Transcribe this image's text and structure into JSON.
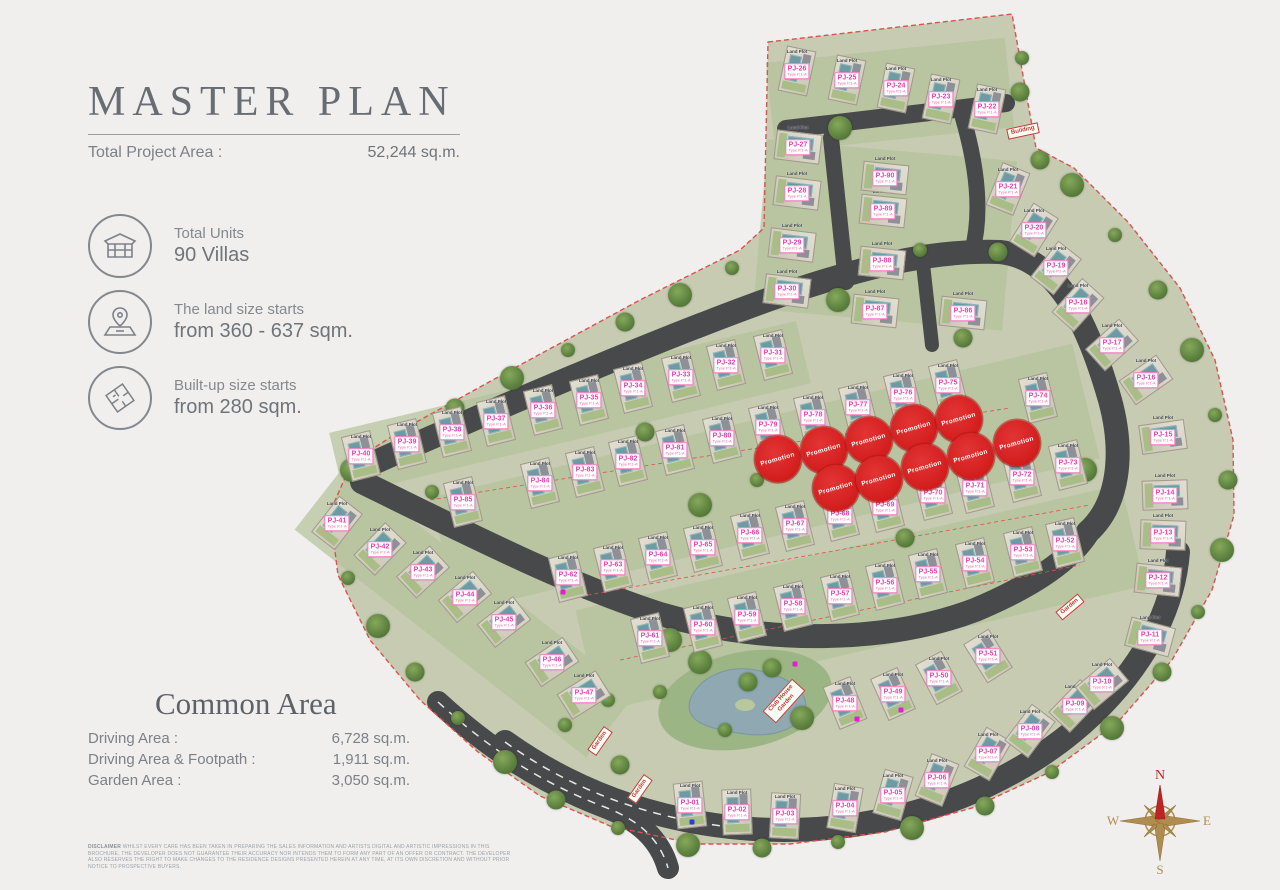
{
  "panel": {
    "title": "MASTER PLAN",
    "total_project_area_label": "Total Project Area :",
    "total_project_area_value": "52,244 sq.m.",
    "stats": [
      {
        "icon": "house-icon",
        "label": "Total Units",
        "value": "90 Villas"
      },
      {
        "icon": "land-pin-icon",
        "label": "The land size starts",
        "value": "from 360 - 637 sqm."
      },
      {
        "icon": "floorplan-icon",
        "label": "Built-up size starts",
        "value": "from 280 sqm."
      }
    ],
    "common_area": {
      "heading": "Common Area",
      "rows": [
        {
          "label": "Driving Area :",
          "value": "6,728 sq.m."
        },
        {
          "label": "Driving Area & Footpath :",
          "value": "1,911 sq.m."
        },
        {
          "label": "Garden Area :",
          "value": "3,050 sq.m."
        }
      ]
    },
    "disclaimer_label": "DISCLAIMER",
    "disclaimer_text": "WHILST EVERY CARE HAS BEEN TAKEN IN PREPARING THE SALES INFORMATION AND ARTISTS DIGITAL AND ARTISTIC IMPRESSIONS IN THIS BROCHURE, THE DEVELOPER DOES NOT GUARANTEE THEIR ACCURACY NOR INTENDS THEM TO FORM ANY PART OF AN OFFER OR CONTRACT. THE DEVELOPER ALSO RESERVES THE RIGHT TO MAKE CHANGES TO THE RESIDENCE DESIGNS PRESENTED HEREIN AT ANY TIME, AT ITS OWN DISCRETION AND WITHOUT PRIOR NOTICE TO PROSPECTIVE BUYERS."
  },
  "map": {
    "land_plot_text": "Land Plot",
    "type_text": "Type P.1-A",
    "promotion_text": "Promotion",
    "compass": {
      "n": "N",
      "e": "E",
      "s": "S",
      "w": "W"
    },
    "plots": [
      {
        "id": "PJ-01",
        "x": 690,
        "y": 805,
        "r": -6
      },
      {
        "id": "PJ-02",
        "x": 737,
        "y": 812,
        "r": -2
      },
      {
        "id": "PJ-03",
        "x": 785,
        "y": 816,
        "r": 3
      },
      {
        "id": "PJ-04",
        "x": 845,
        "y": 808,
        "r": 10
      },
      {
        "id": "PJ-05",
        "x": 893,
        "y": 795,
        "r": 16
      },
      {
        "id": "PJ-06",
        "x": 937,
        "y": 780,
        "r": 22
      },
      {
        "id": "PJ-07",
        "x": 988,
        "y": 754,
        "r": 30
      },
      {
        "id": "PJ-08",
        "x": 1030,
        "y": 731,
        "r": 37
      },
      {
        "id": "PJ-09",
        "x": 1075,
        "y": 706,
        "r": 44
      },
      {
        "id": "PJ-10",
        "x": 1102,
        "y": 684,
        "r": 50
      },
      {
        "id": "PJ-11",
        "x": 1150,
        "y": 637,
        "r": 105
      },
      {
        "id": "PJ-12",
        "x": 1158,
        "y": 580,
        "r": 96
      },
      {
        "id": "PJ-13",
        "x": 1163,
        "y": 535,
        "r": 92
      },
      {
        "id": "PJ-14",
        "x": 1165,
        "y": 495,
        "r": 88
      },
      {
        "id": "PJ-15",
        "x": 1163,
        "y": 437,
        "r": 82
      },
      {
        "id": "PJ-16",
        "x": 1146,
        "y": 380,
        "r": 55
      },
      {
        "id": "PJ-17",
        "x": 1112,
        "y": 345,
        "r": 48
      },
      {
        "id": "PJ-18",
        "x": 1078,
        "y": 305,
        "r": 42
      },
      {
        "id": "PJ-19",
        "x": 1056,
        "y": 268,
        "r": 38
      },
      {
        "id": "PJ-20",
        "x": 1034,
        "y": 230,
        "r": 32
      },
      {
        "id": "PJ-21",
        "x": 1008,
        "y": 189,
        "r": 22
      },
      {
        "id": "PJ-22",
        "x": 987,
        "y": 109,
        "r": 12
      },
      {
        "id": "PJ-23",
        "x": 941,
        "y": 99,
        "r": 12
      },
      {
        "id": "PJ-24",
        "x": 896,
        "y": 88,
        "r": 12
      },
      {
        "id": "PJ-25",
        "x": 847,
        "y": 80,
        "r": 12
      },
      {
        "id": "PJ-26",
        "x": 797,
        "y": 71,
        "r": 12
      },
      {
        "id": "PJ-27",
        "x": 798,
        "y": 147,
        "r": 97
      },
      {
        "id": "PJ-28",
        "x": 797,
        "y": 193,
        "r": 97
      },
      {
        "id": "PJ-29",
        "x": 792,
        "y": 245,
        "r": 97
      },
      {
        "id": "PJ-30",
        "x": 787,
        "y": 291,
        "r": 97
      },
      {
        "id": "PJ-31",
        "x": 773,
        "y": 355,
        "r": -14
      },
      {
        "id": "PJ-32",
        "x": 726,
        "y": 365,
        "r": -14
      },
      {
        "id": "PJ-33",
        "x": 681,
        "y": 377,
        "r": -14
      },
      {
        "id": "PJ-34",
        "x": 633,
        "y": 388,
        "r": -14
      },
      {
        "id": "PJ-35",
        "x": 589,
        "y": 400,
        "r": -14
      },
      {
        "id": "PJ-36",
        "x": 543,
        "y": 410,
        "r": -14
      },
      {
        "id": "PJ-37",
        "x": 496,
        "y": 421,
        "r": -14
      },
      {
        "id": "PJ-38",
        "x": 452,
        "y": 432,
        "r": -14
      },
      {
        "id": "PJ-39",
        "x": 407,
        "y": 444,
        "r": -14
      },
      {
        "id": "PJ-40",
        "x": 361,
        "y": 456,
        "r": -14
      },
      {
        "id": "PJ-41",
        "x": 337,
        "y": 523,
        "r": 38
      },
      {
        "id": "PJ-42",
        "x": 380,
        "y": 549,
        "r": 44
      },
      {
        "id": "PJ-43",
        "x": 423,
        "y": 572,
        "r": 47
      },
      {
        "id": "PJ-44",
        "x": 465,
        "y": 597,
        "r": 50
      },
      {
        "id": "PJ-45",
        "x": 504,
        "y": 622,
        "r": 52
      },
      {
        "id": "PJ-46",
        "x": 552,
        "y": 662,
        "r": 56
      },
      {
        "id": "PJ-47",
        "x": 584,
        "y": 695,
        "r": 58
      },
      {
        "id": "PJ-48",
        "x": 845,
        "y": 703,
        "r": -22
      },
      {
        "id": "PJ-49",
        "x": 893,
        "y": 694,
        "r": -24
      },
      {
        "id": "PJ-50",
        "x": 939,
        "y": 678,
        "r": -28
      },
      {
        "id": "PJ-51",
        "x": 988,
        "y": 656,
        "r": -32
      },
      {
        "id": "PJ-52",
        "x": 1065,
        "y": 543,
        "r": -14
      },
      {
        "id": "PJ-53",
        "x": 1023,
        "y": 552,
        "r": -14
      },
      {
        "id": "PJ-54",
        "x": 975,
        "y": 563,
        "r": -14
      },
      {
        "id": "PJ-55",
        "x": 928,
        "y": 574,
        "r": -14
      },
      {
        "id": "PJ-56",
        "x": 885,
        "y": 585,
        "r": -14
      },
      {
        "id": "PJ-57",
        "x": 840,
        "y": 596,
        "r": -14
      },
      {
        "id": "PJ-58",
        "x": 793,
        "y": 606,
        "r": -14
      },
      {
        "id": "PJ-59",
        "x": 747,
        "y": 617,
        "r": -14
      },
      {
        "id": "PJ-60",
        "x": 703,
        "y": 627,
        "r": -14
      },
      {
        "id": "PJ-61",
        "x": 650,
        "y": 638,
        "r": -14
      },
      {
        "id": "PJ-62",
        "x": 568,
        "y": 577,
        "r": -14
      },
      {
        "id": "PJ-63",
        "x": 613,
        "y": 567,
        "r": -14
      },
      {
        "id": "PJ-64",
        "x": 658,
        "y": 557,
        "r": -14
      },
      {
        "id": "PJ-65",
        "x": 703,
        "y": 547,
        "r": -14
      },
      {
        "id": "PJ-66",
        "x": 750,
        "y": 535,
        "r": -14
      },
      {
        "id": "PJ-67",
        "x": 795,
        "y": 526,
        "r": -14
      },
      {
        "id": "PJ-68",
        "x": 840,
        "y": 516,
        "r": -14
      },
      {
        "id": "PJ-69",
        "x": 885,
        "y": 507,
        "r": -14
      },
      {
        "id": "PJ-70",
        "x": 933,
        "y": 495,
        "r": -14
      },
      {
        "id": "PJ-71",
        "x": 975,
        "y": 488,
        "r": -14
      },
      {
        "id": "PJ-72",
        "x": 1022,
        "y": 477,
        "r": -14
      },
      {
        "id": "PJ-73",
        "x": 1068,
        "y": 465,
        "r": -14
      },
      {
        "id": "PJ-74",
        "x": 1038,
        "y": 398,
        "r": -14
      },
      {
        "id": "PJ-75",
        "x": 948,
        "y": 385,
        "r": -14
      },
      {
        "id": "PJ-76",
        "x": 903,
        "y": 395,
        "r": -14
      },
      {
        "id": "PJ-77",
        "x": 858,
        "y": 407,
        "r": -14
      },
      {
        "id": "PJ-78",
        "x": 813,
        "y": 417,
        "r": -14
      },
      {
        "id": "PJ-79",
        "x": 768,
        "y": 427,
        "r": -14
      },
      {
        "id": "PJ-80",
        "x": 722,
        "y": 438,
        "r": -14
      },
      {
        "id": "PJ-81",
        "x": 675,
        "y": 450,
        "r": -14
      },
      {
        "id": "PJ-82",
        "x": 628,
        "y": 461,
        "r": -14
      },
      {
        "id": "PJ-83",
        "x": 585,
        "y": 472,
        "r": -14
      },
      {
        "id": "PJ-84",
        "x": 540,
        "y": 483,
        "r": -14
      },
      {
        "id": "PJ-85",
        "x": 463,
        "y": 502,
        "r": -14
      },
      {
        "id": "PJ-86",
        "x": 963,
        "y": 313,
        "r": 96
      },
      {
        "id": "PJ-87",
        "x": 875,
        "y": 311,
        "r": 96
      },
      {
        "id": "PJ-88",
        "x": 882,
        "y": 263,
        "r": 96
      },
      {
        "id": "PJ-89",
        "x": 883,
        "y": 211,
        "r": 96
      },
      {
        "id": "PJ-90",
        "x": 885,
        "y": 178,
        "r": 96
      }
    ],
    "promotions": [
      {
        "x": 778,
        "y": 459
      },
      {
        "x": 824,
        "y": 450
      },
      {
        "x": 869,
        "y": 440
      },
      {
        "x": 914,
        "y": 428
      },
      {
        "x": 959,
        "y": 419
      },
      {
        "x": 1017,
        "y": 443
      },
      {
        "x": 836,
        "y": 488
      },
      {
        "x": 879,
        "y": 479
      },
      {
        "x": 925,
        "y": 467
      },
      {
        "x": 971,
        "y": 456
      }
    ],
    "signs": [
      {
        "text": "Garden",
        "x": 600,
        "y": 741,
        "r": -55
      },
      {
        "text": "Garden",
        "x": 640,
        "y": 789,
        "r": -55
      },
      {
        "text": "Club House Garden",
        "x": 784,
        "y": 701,
        "r": -48
      },
      {
        "text": "Garden",
        "x": 1070,
        "y": 607,
        "r": -40
      },
      {
        "text": "Building",
        "x": 1023,
        "y": 131,
        "r": -12
      }
    ],
    "trees": [
      [
        1022,
        58
      ],
      [
        1040,
        160
      ],
      [
        1072,
        185
      ],
      [
        1115,
        235
      ],
      [
        1158,
        290
      ],
      [
        1192,
        350
      ],
      [
        1215,
        415
      ],
      [
        1228,
        480
      ],
      [
        1222,
        550
      ],
      [
        1198,
        612
      ],
      [
        1162,
        672
      ],
      [
        1112,
        728
      ],
      [
        1052,
        772
      ],
      [
        985,
        806
      ],
      [
        912,
        828
      ],
      [
        838,
        842
      ],
      [
        762,
        848
      ],
      [
        688,
        845
      ],
      [
        618,
        828
      ],
      [
        556,
        800
      ],
      [
        505,
        762
      ],
      [
        458,
        718
      ],
      [
        415,
        672
      ],
      [
        378,
        626
      ],
      [
        348,
        578
      ],
      [
        335,
        522
      ],
      [
        352,
        470
      ],
      [
        400,
        438
      ],
      [
        455,
        408
      ],
      [
        512,
        378
      ],
      [
        568,
        350
      ],
      [
        625,
        322
      ],
      [
        680,
        295
      ],
      [
        732,
        268
      ],
      [
        1020,
        92
      ],
      [
        840,
        128
      ],
      [
        920,
        250
      ],
      [
        998,
        252
      ],
      [
        838,
        300
      ],
      [
        432,
        492
      ],
      [
        645,
        432
      ],
      [
        700,
        505
      ],
      [
        757,
        480
      ],
      [
        905,
        538
      ],
      [
        1085,
        470
      ],
      [
        660,
        692
      ],
      [
        748,
        682
      ],
      [
        802,
        718
      ],
      [
        725,
        730
      ],
      [
        772,
        668
      ],
      [
        700,
        662
      ],
      [
        565,
        725
      ],
      [
        620,
        765
      ],
      [
        670,
        640
      ],
      [
        608,
        700
      ],
      [
        963,
        338
      ]
    ],
    "dots": [
      {
        "x": 563,
        "y": 592,
        "color": "#e51fd1"
      },
      {
        "x": 857,
        "y": 719,
        "color": "#e51fd1"
      },
      {
        "x": 901,
        "y": 710,
        "color": "#e51fd1"
      },
      {
        "x": 795,
        "y": 664,
        "color": "#e51fd1"
      },
      {
        "x": 692,
        "y": 822,
        "color": "#2b3fd8"
      }
    ]
  }
}
